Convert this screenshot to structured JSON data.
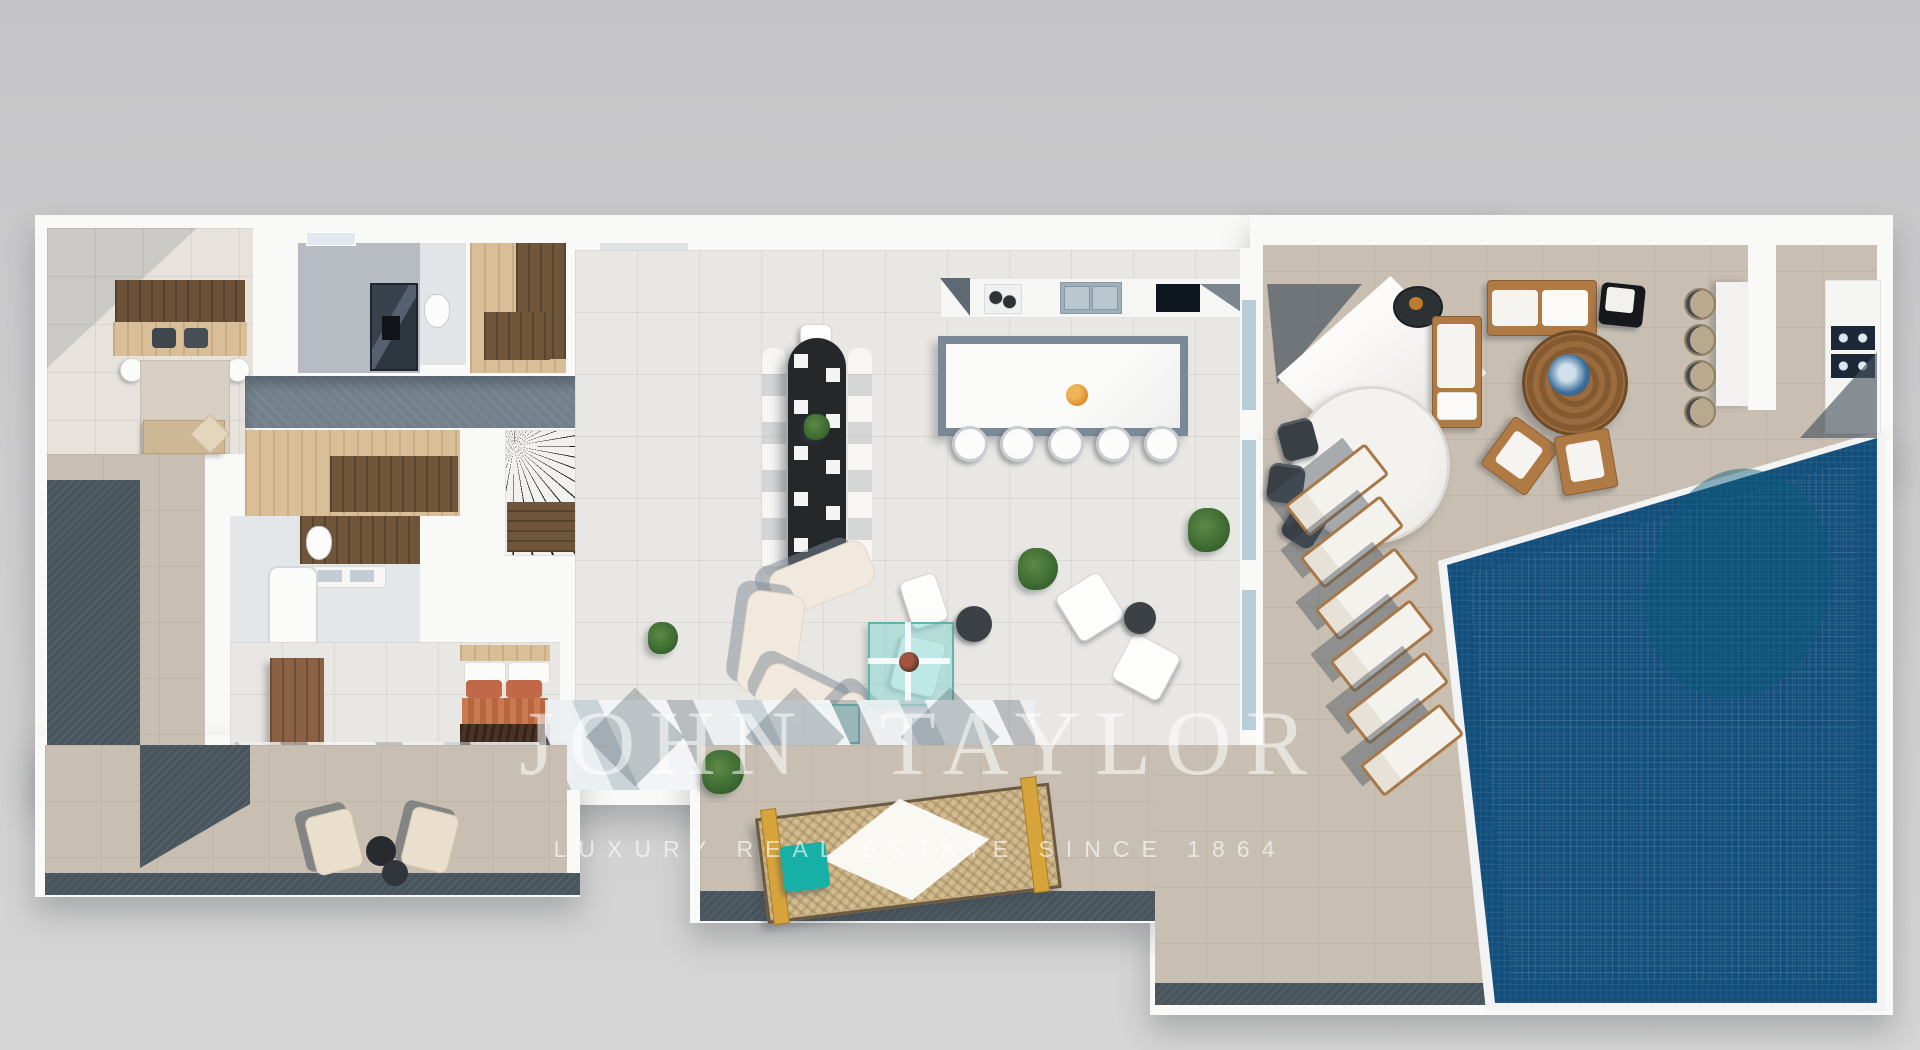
{
  "watermark": {
    "brand": "JOHN TAYLOR",
    "tagline": "LUXURY REAL ESTATE SINCE 1864"
  },
  "palette": {
    "background": "#cbcbcd",
    "walls": "#f9f9f8",
    "interior_floor": "#e9e7e3",
    "terrace_stone": "#c8bfb2",
    "stone_edge_dark": "#49555d",
    "corridor_stone": "#72808c",
    "wood_light": "#d9be97",
    "wood_dark": "#6f563b",
    "wood_furniture": "#b07a44",
    "cushion_cream": "#f1e9dd",
    "pool_water": "#2bbfd4",
    "pool_border": "#134f7d",
    "glass_teal": "#7fd4cd",
    "terracotta": "#c06848",
    "teal_cube": "#17b0a6",
    "fruit_orange": "#e08f2c",
    "plant_green": "#3f6d33"
  },
  "elements": {
    "interior_rooms": [
      "master-bedroom",
      "shower-room",
      "wc",
      "walk-in-closet",
      "guest-wc",
      "hallway",
      "dressing-room",
      "staircase",
      "bathroom",
      "second-bedroom",
      "open-living-area",
      "kitchen",
      "dining-area"
    ],
    "interior_furniture": [
      "double-bed",
      "bedside-poufs",
      "area-rug",
      "bedroom-bench",
      "shower-unit",
      "toilet",
      "closet-counters",
      "wardrobe-counters",
      "bathtub",
      "double-vanity",
      "second-bed",
      "wooden-dresser",
      "oval-dining-table",
      "dining-chairs",
      "kitchen-wall-counter",
      "cooktop",
      "double-sink",
      "black-hob",
      "kitchen-island",
      "bar-stools",
      "curved-sofa",
      "glass-coffee-table",
      "glass-side-table",
      "lounge-armchairs",
      "round-side-tables",
      "potted-plants"
    ],
    "outdoor": [
      "shade-sail-pergola",
      "fire-bowl",
      "outdoor-bench",
      "round-marble-table",
      "outdoor-dining-chairs",
      "outdoor-sofa",
      "black-ottoman",
      "round-wood-coffee-table",
      "outdoor-armchairs",
      "pool-bar-counter",
      "wicker-bar-stools",
      "outdoor-kitchen-bbq",
      "sun-loungers",
      "swimming-pool",
      "daybed-hammock",
      "teal-cube-stool",
      "terrace-armchairs",
      "terrace-side-tables",
      "olive-tree"
    ]
  }
}
